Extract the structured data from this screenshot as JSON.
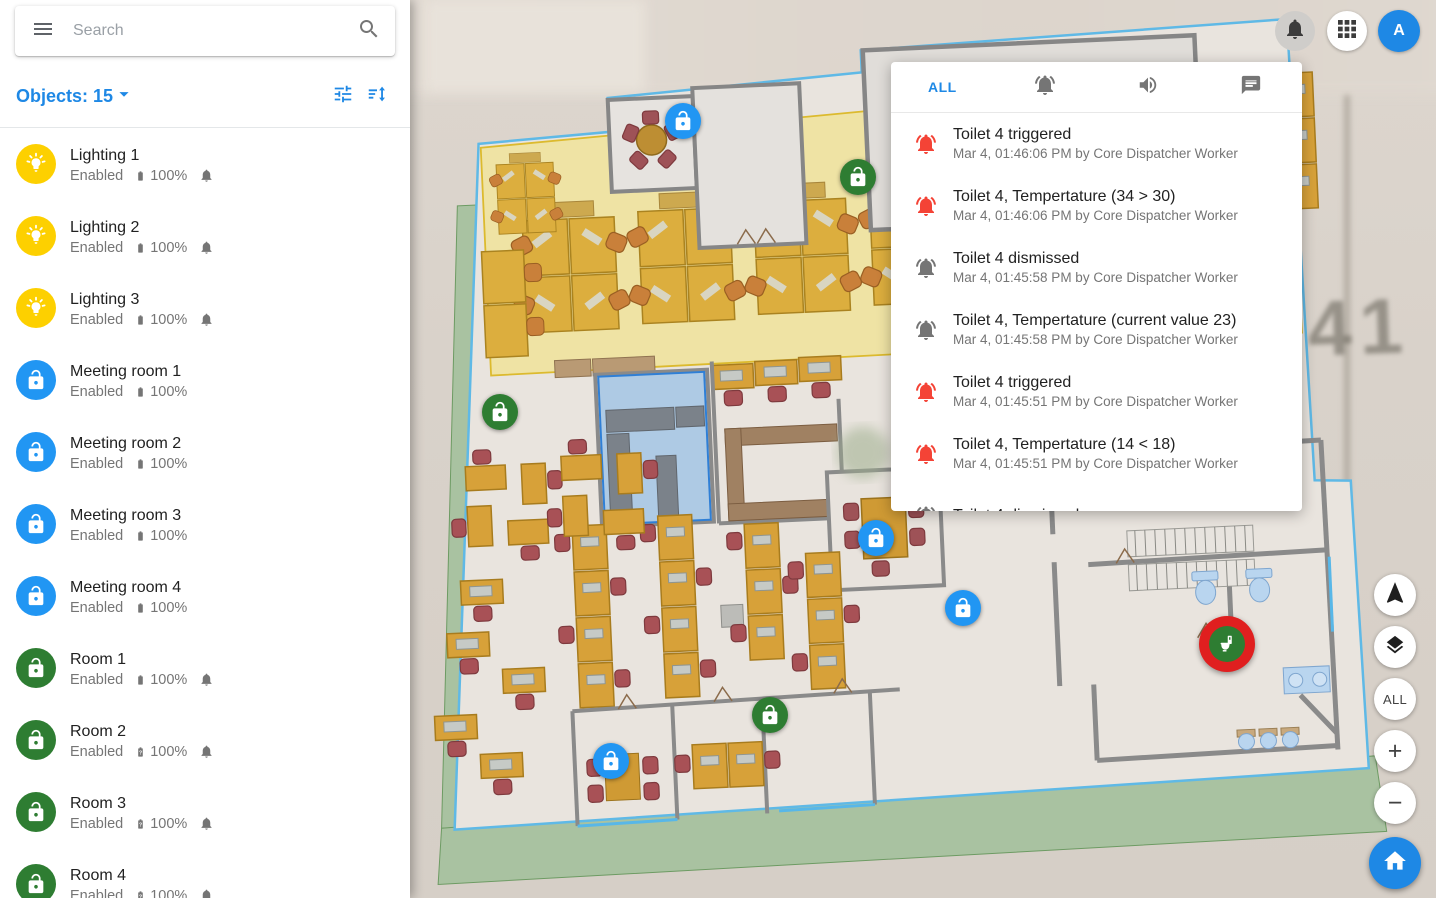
{
  "topbar": {
    "avatar_letter": "A"
  },
  "sidebar": {
    "search_placeholder": "Search",
    "objects_label": "Objects:",
    "objects_count": "15",
    "items": [
      {
        "name": "Lighting 1",
        "status": "Enabled",
        "battery": "100%",
        "icon": "lightbulb",
        "color": "#fdd000",
        "battery_unknown": false,
        "bell": true
      },
      {
        "name": "Lighting 2",
        "status": "Enabled",
        "battery": "100%",
        "icon": "lightbulb",
        "color": "#fdd000",
        "battery_unknown": false,
        "bell": true
      },
      {
        "name": "Lighting 3",
        "status": "Enabled",
        "battery": "100%",
        "icon": "lightbulb",
        "color": "#fdd000",
        "battery_unknown": false,
        "bell": true
      },
      {
        "name": "Meeting room 1",
        "status": "Enabled",
        "battery": "100%",
        "icon": "lock-open",
        "color": "#2196f3",
        "battery_unknown": false,
        "bell": false
      },
      {
        "name": "Meeting room 2",
        "status": "Enabled",
        "battery": "100%",
        "icon": "lock-open",
        "color": "#2196f3",
        "battery_unknown": false,
        "bell": false
      },
      {
        "name": "Meeting room 3",
        "status": "Enabled",
        "battery": "100%",
        "icon": "lock-open",
        "color": "#2196f3",
        "battery_unknown": false,
        "bell": false
      },
      {
        "name": "Meeting room 4",
        "status": "Enabled",
        "battery": "100%",
        "icon": "lock-open",
        "color": "#2196f3",
        "battery_unknown": false,
        "bell": false
      },
      {
        "name": "Room 1",
        "status": "Enabled",
        "battery": "100%",
        "icon": "lock-open",
        "color": "#2e7d32",
        "battery_unknown": false,
        "bell": true
      },
      {
        "name": "Room 2",
        "status": "Enabled",
        "battery": "100%",
        "icon": "lock-open",
        "color": "#2e7d32",
        "battery_unknown": true,
        "bell": true
      },
      {
        "name": "Room 3",
        "status": "Enabled",
        "battery": "100%",
        "icon": "lock-open",
        "color": "#2e7d32",
        "battery_unknown": true,
        "bell": true
      },
      {
        "name": "Room 4",
        "status": "Enabled",
        "battery": "100%",
        "icon": "lock-open",
        "color": "#2e7d32",
        "battery_unknown": true,
        "bell": true
      }
    ]
  },
  "notifications": {
    "tabs": [
      {
        "id": "all",
        "label": "ALL",
        "active": true
      },
      {
        "id": "alarms",
        "icon": "bell-ring",
        "active": false
      },
      {
        "id": "sounds",
        "icon": "volume",
        "active": false
      },
      {
        "id": "messages",
        "icon": "chat",
        "active": false
      }
    ],
    "items": [
      {
        "title": "Toilet 4 triggered",
        "meta": "Mar 4, 01:46:06 PM by Core Dispatcher Worker",
        "level": "alarm"
      },
      {
        "title": "Toilet 4, Tempertature (34 > 30)",
        "meta": "Mar 4, 01:46:06 PM by Core Dispatcher Worker",
        "level": "alarm"
      },
      {
        "title": "Toilet 4 dismissed",
        "meta": "Mar 4, 01:45:58 PM by Core Dispatcher Worker",
        "level": "info"
      },
      {
        "title": "Toilet 4, Tempertature (current value 23)",
        "meta": "Mar 4, 01:45:58 PM by Core Dispatcher Worker",
        "level": "info"
      },
      {
        "title": "Toilet 4 triggered",
        "meta": "Mar 4, 01:45:51 PM by Core Dispatcher Worker",
        "level": "alarm"
      },
      {
        "title": "Toilet 4, Tempertature (14 < 18)",
        "meta": "Mar 4, 01:45:51 PM by Core Dispatcher Worker",
        "level": "alarm"
      },
      {
        "title": "Toilet 4 dismissed",
        "meta": "",
        "level": "info"
      }
    ],
    "colors": {
      "alarm": "#f44336",
      "info": "#757575"
    }
  },
  "map": {
    "background_label": "41",
    "controls": {
      "fit_all": "ALL",
      "zoom_in": "+",
      "zoom_out": "−"
    },
    "markers": [
      {
        "id": "marker-1",
        "type": "lock-open",
        "color": "#2196f3",
        "x": 683,
        "y": 121
      },
      {
        "id": "marker-2",
        "type": "lock-open",
        "color": "#2e7d32",
        "x": 858,
        "y": 177
      },
      {
        "id": "marker-3",
        "type": "lock-open",
        "color": "#2e7d32",
        "x": 500,
        "y": 412
      },
      {
        "id": "marker-4",
        "type": "lock-open",
        "color": "#2196f3",
        "x": 876,
        "y": 538
      },
      {
        "id": "marker-5",
        "type": "lock-open",
        "color": "#2196f3",
        "x": 963,
        "y": 608
      },
      {
        "id": "marker-6",
        "type": "lock-open",
        "color": "#2e7d32",
        "x": 770,
        "y": 715
      },
      {
        "id": "marker-7",
        "type": "lock-open",
        "color": "#2196f3",
        "x": 611,
        "y": 761
      },
      {
        "id": "marker-toilet",
        "type": "toilet-alarm",
        "color": "#e01f1f",
        "inner_color": "#2e7d32",
        "x": 1227,
        "y": 644
      }
    ]
  }
}
